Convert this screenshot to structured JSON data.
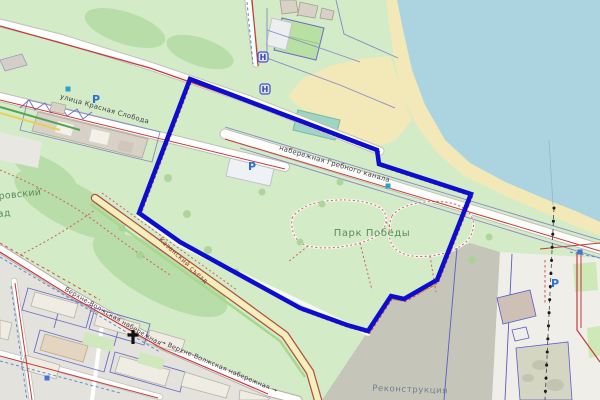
{
  "map": {
    "description": "OpenStreetMap-style city map with a thick blue selection polygon around Park Pobedy / Grebnoy canal embankment area",
    "labels": {
      "krasnaya_sloboda": {
        "text": "улица Красная Слобода"
      },
      "nab_grebnogo": {
        "text": "набережная Гребного канала"
      },
      "park_pobedy": {
        "text": "Парк Победы"
      },
      "aleksandrovsky_line1": {
        "text": "дровский"
      },
      "aleksandrovsky_line2": {
        "text": "ад"
      },
      "verhnevolzhskaya_1": {
        "text": "Верхне-Волжская набережная"
      },
      "verhnevolzhskaya_2": {
        "text": "→ Верхне-Волжская набережная →"
      },
      "kazansky": {
        "text": "Казанский съезд"
      },
      "rekonstrukciya": {
        "text": "Реконструкция"
      }
    },
    "icons": {
      "parking": {
        "glyph": "P",
        "color": "#2a72d8",
        "positions": [
          [
            96,
            99
          ],
          [
            252,
            166
          ],
          [
            555,
            283
          ]
        ]
      },
      "bus_stop": {
        "glyph": "H",
        "color": "#3945b8",
        "positions": [
          [
            263,
            57
          ],
          [
            265,
            89
          ]
        ]
      },
      "church_cross": {
        "position": [
          133,
          337
        ],
        "color": "#111111"
      },
      "marker_squares": {
        "positions": [
          [
            68,
            89
          ],
          [
            388,
            186
          ],
          [
            47,
            378
          ],
          [
            580,
            252
          ]
        ]
      }
    },
    "overlay": {
      "points_str": "190,79 377,150 379,164 471,194 437,280 404,299 391,296 368,331 347,325 300,308 180,242 139,213",
      "color": "#0d0dd0",
      "stroke_width": "4.5"
    },
    "colors": {
      "water": "#abd4e0",
      "land_green": "#d3ecc7",
      "wood_green": "#b9dda8",
      "beach_sand": "#f2e8b8",
      "residential_gray": "#e4e2dd",
      "construction_gray": "#c5c6b9",
      "route_red": "#c43c3c",
      "boundary_red_dashed": "#cf4545",
      "fence_purple": "#8888c8",
      "plot_purple": "#6b6bc9",
      "pitch_teal": "#9ed5c3"
    }
  }
}
